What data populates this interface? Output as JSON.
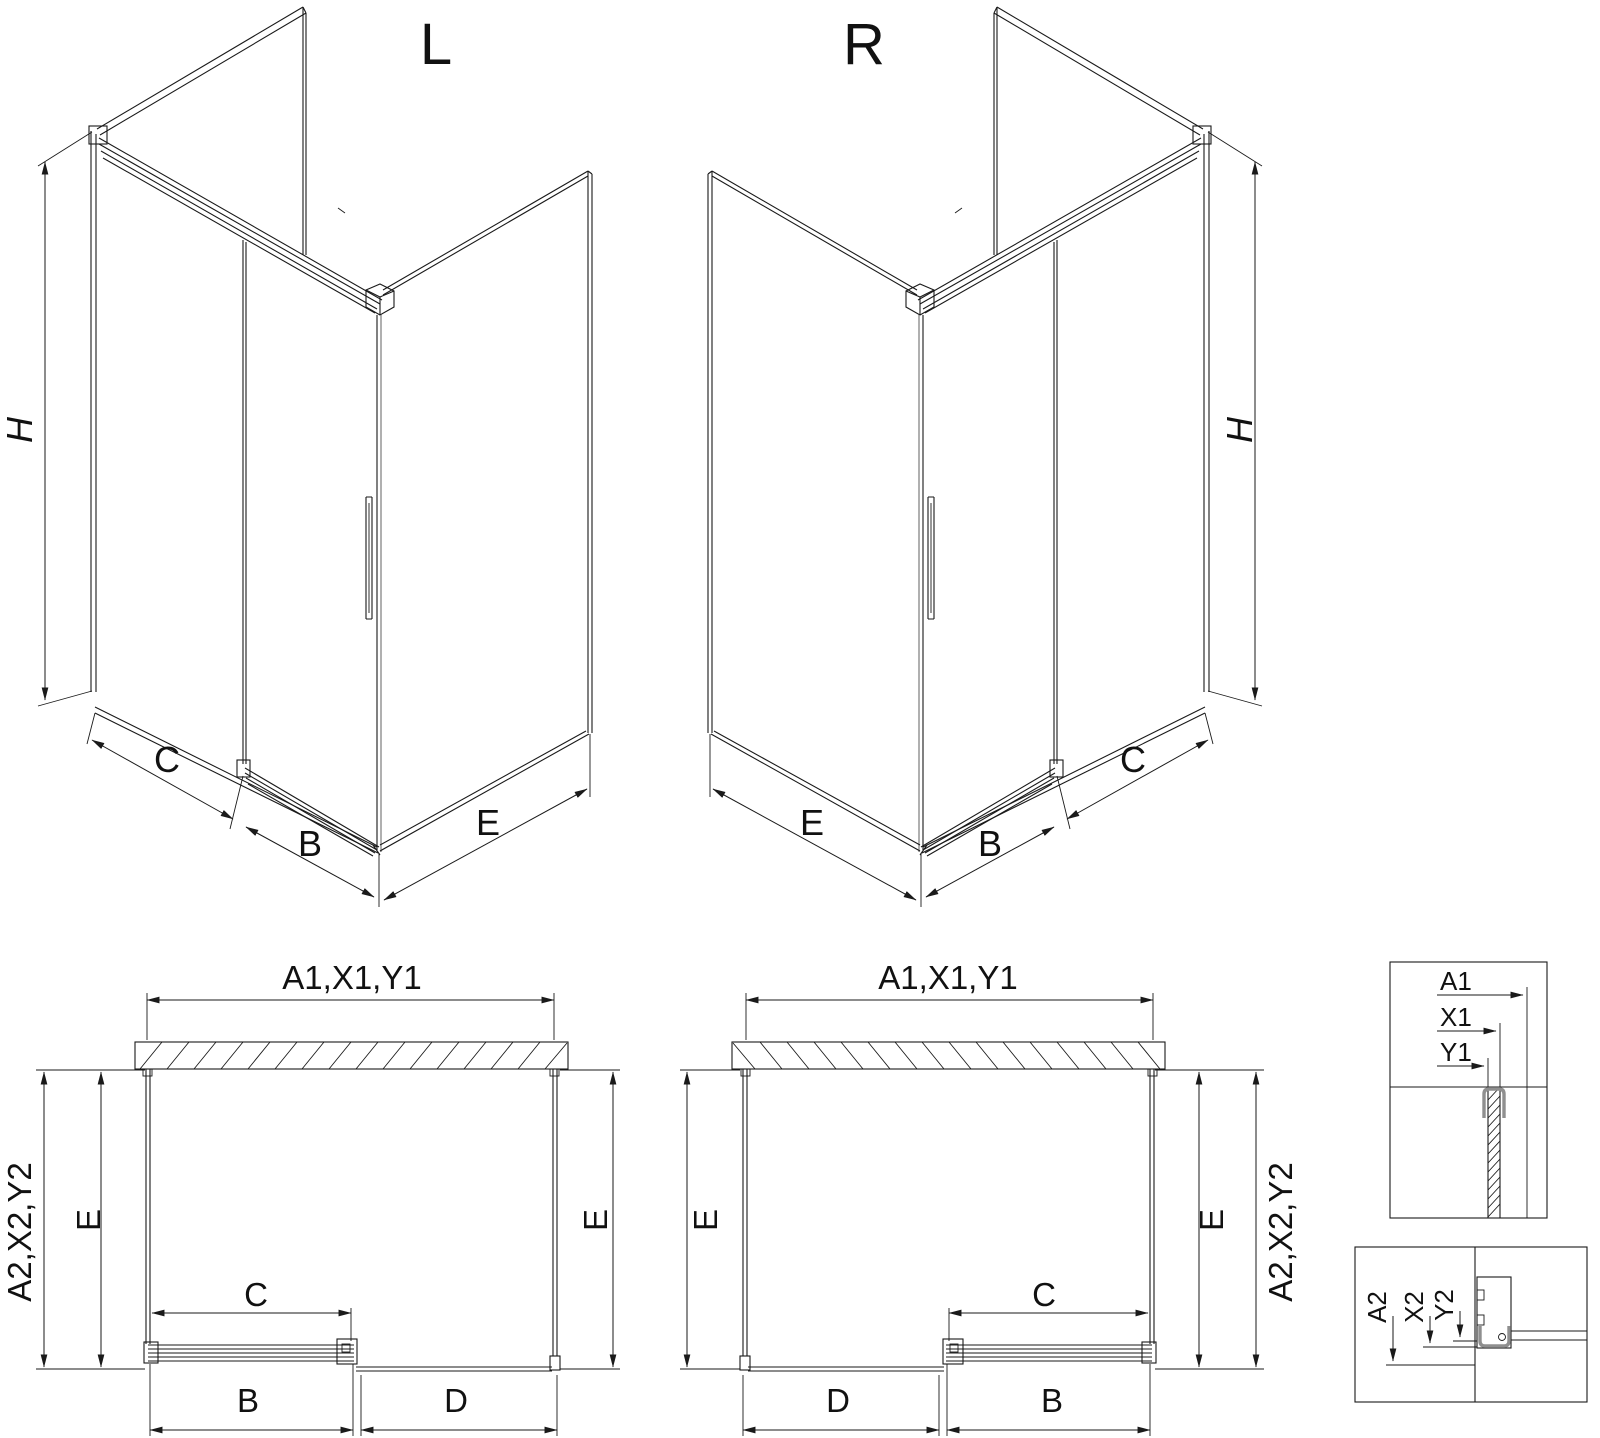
{
  "drawing": {
    "background": "#ffffff",
    "line_color": "#1a1a1a",
    "accent_gray": "#8f8f8f"
  },
  "labels": {
    "iso_left": {
      "title": "L",
      "height": "H",
      "fixed_width": "C",
      "door_width": "B",
      "side_width": "E"
    },
    "iso_right": {
      "title": "R",
      "height": "H",
      "fixed_width": "C",
      "door_width": "B",
      "side_width": "E"
    },
    "plan_left": {
      "wall_span": "A1,X1,Y1",
      "depth_outer": "A2,X2,Y2",
      "depth_left": "E",
      "depth_right": "E",
      "opening": "C",
      "door": "B",
      "panel": "D"
    },
    "plan_right": {
      "wall_span": "A1,X1,Y1",
      "depth_outer": "A2,X2,Y2",
      "depth_left": "E",
      "depth_right": "E",
      "opening": "C",
      "door": "B",
      "panel": "D"
    },
    "detail_top": {
      "dim_a": "A1",
      "dim_x": "X1",
      "dim_y": "Y1"
    },
    "detail_bottom": {
      "dim_a": "A2",
      "dim_x": "X2",
      "dim_y": "Y2"
    }
  }
}
